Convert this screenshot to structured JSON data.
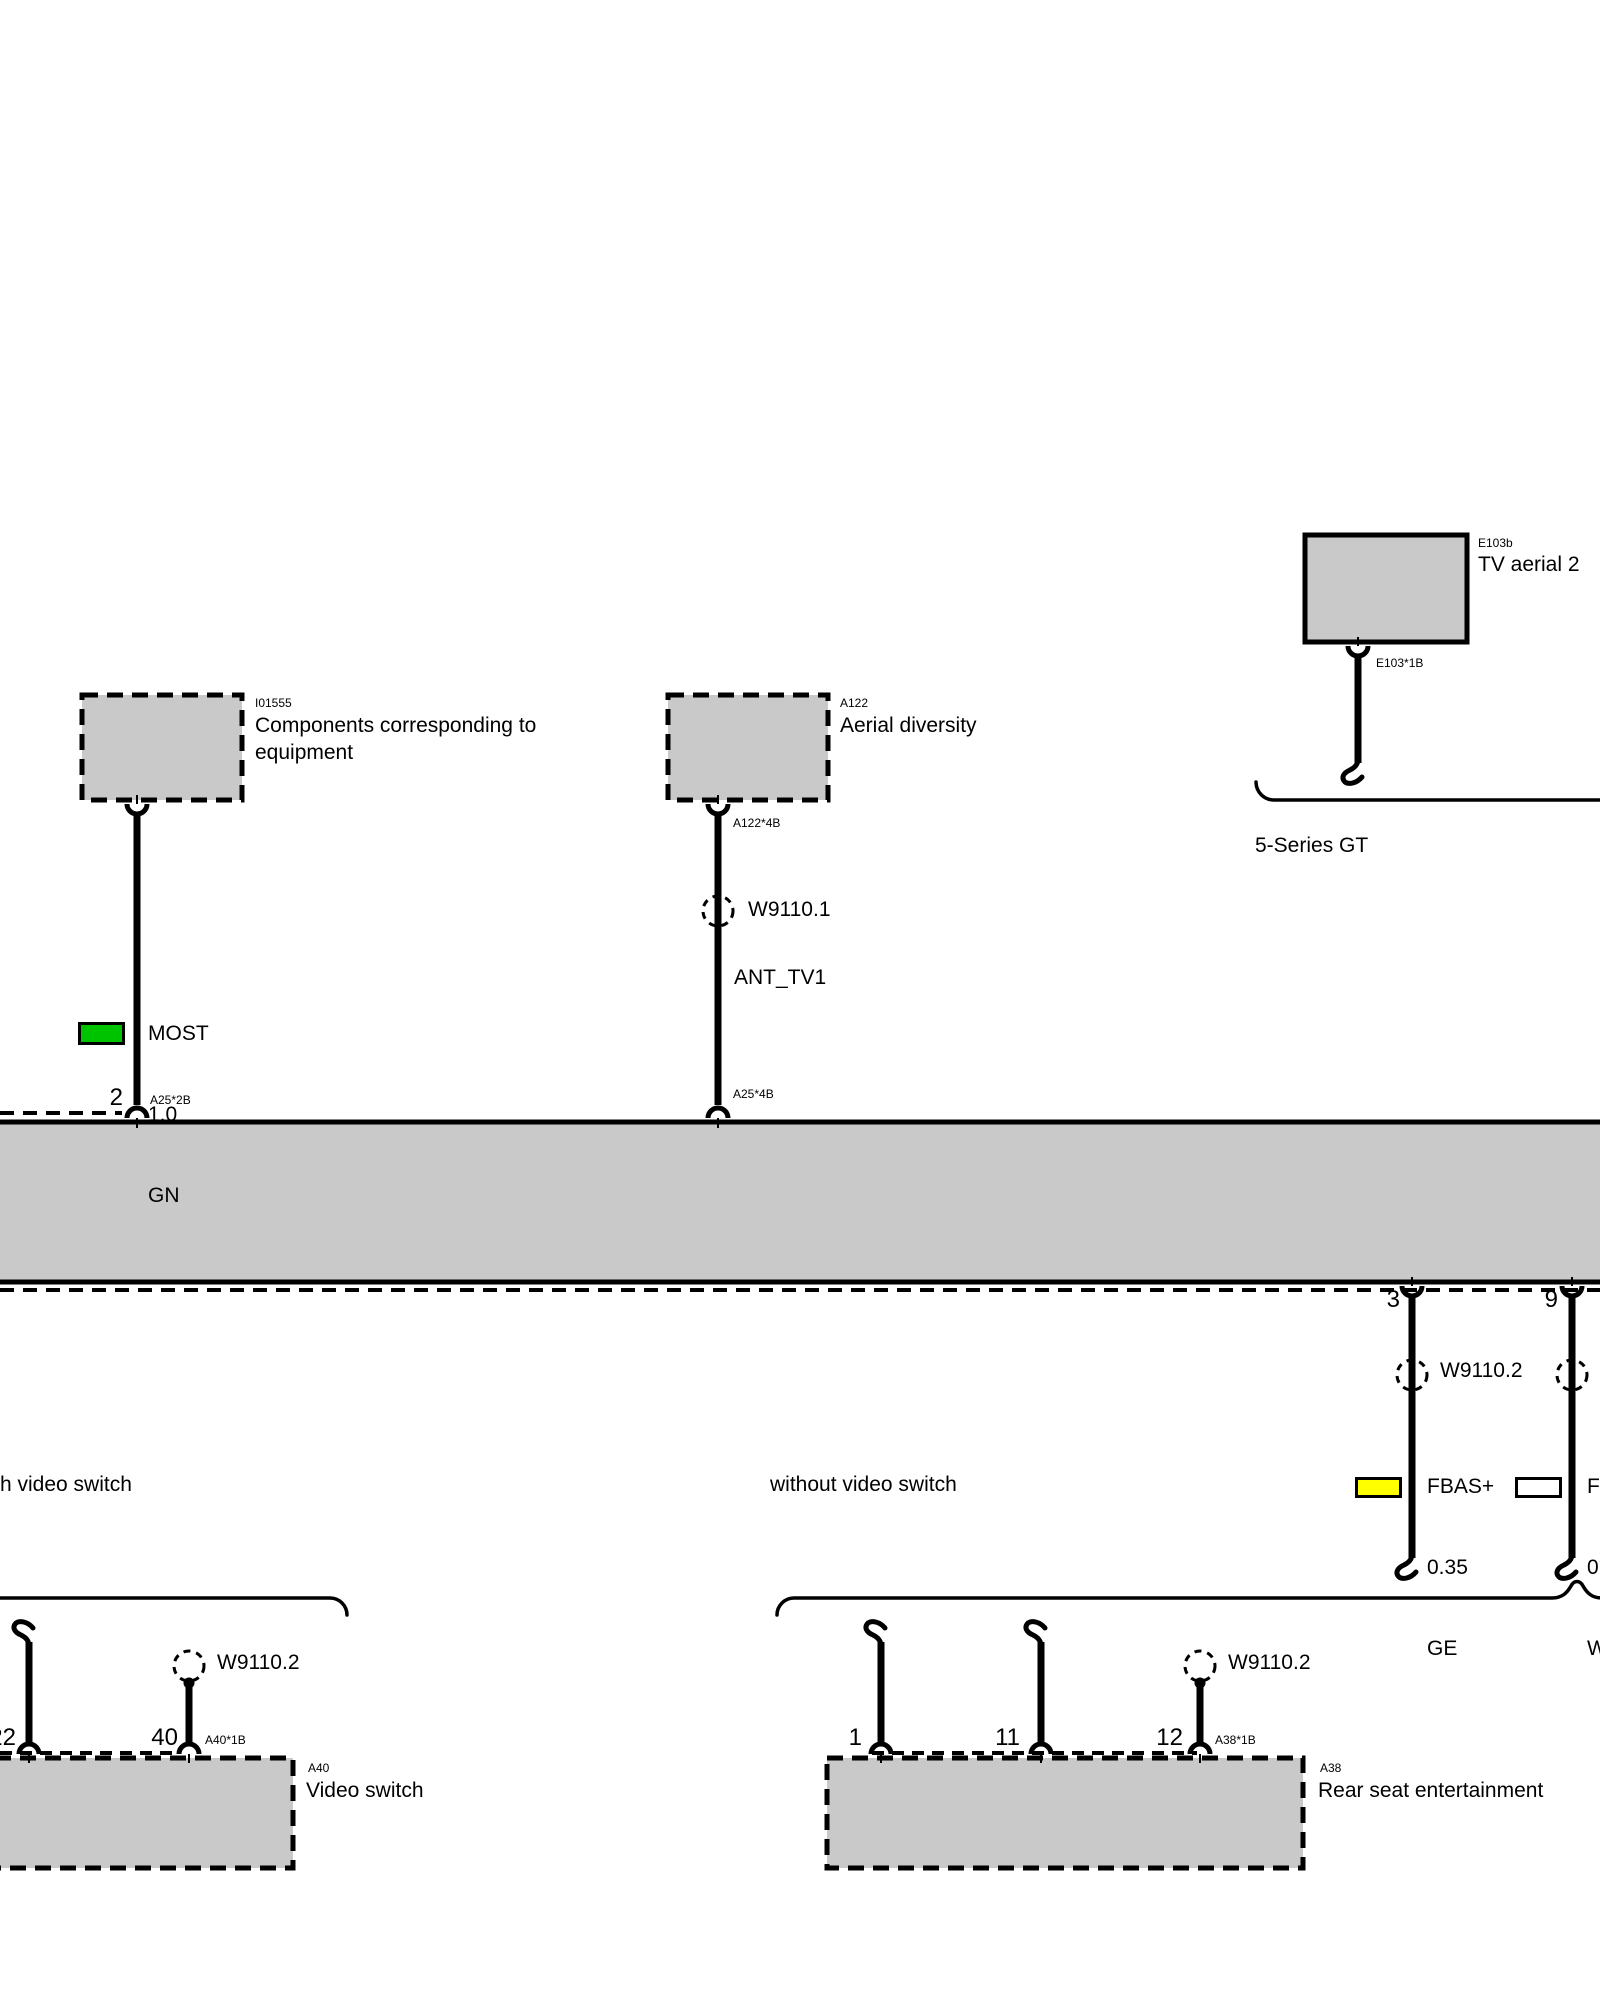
{
  "palette": {
    "background": "#ffffff",
    "box_fill": "#c9c9c9",
    "line": "#000000"
  },
  "boxes": {
    "tv_aerial": {
      "code": "E103b",
      "label": "TV aerial 2"
    },
    "components": {
      "code": "I01555",
      "label": "Components corresponding to equipment"
    },
    "aerial_diversity": {
      "code": "A122",
      "label": "Aerial diversity"
    },
    "video_switch": {
      "code": "A40",
      "label": "Video switch"
    },
    "rear_seat": {
      "code": "A38",
      "label": "Rear seat entertainment"
    }
  },
  "connectors": {
    "e103_1b": "E103*1B",
    "a122_4b": "A122*4B",
    "a25_4b": "A25*4B",
    "a25_2b": "A25*2B",
    "a40_1b": "A40*1B",
    "a38_1b": "A38*1B"
  },
  "pins": {
    "p2": "2",
    "p3": "3",
    "p9": "9",
    "p22": "22",
    "p40": "40",
    "p1": "1",
    "p11": "11",
    "p12": "12"
  },
  "splices": {
    "w9110_1": "W9110.1",
    "w9110_2_main": "W9110.2",
    "w9110_2_video": "W9110.2",
    "w9110_2_rear": "W9110.2"
  },
  "wires": {
    "most": {
      "name": "MOST",
      "size": "1.0",
      "color_code": "GN",
      "color_hex": "#00c300"
    },
    "ant_tv1": {
      "name": "ANT_TV1"
    },
    "fbas_plus": {
      "name": "FBAS+",
      "size": "0.35",
      "color_code": "GE",
      "color_hex": "#ffff00"
    },
    "fbas_minus": {
      "name": "FBAS-",
      "size": "0.35",
      "color_code": "WS",
      "color_hex": "#ffffff"
    }
  },
  "captions": {
    "five_series_gt": "5-Series GT",
    "with_video_switch": "h video switch",
    "without_video_switch": "without video switch"
  }
}
